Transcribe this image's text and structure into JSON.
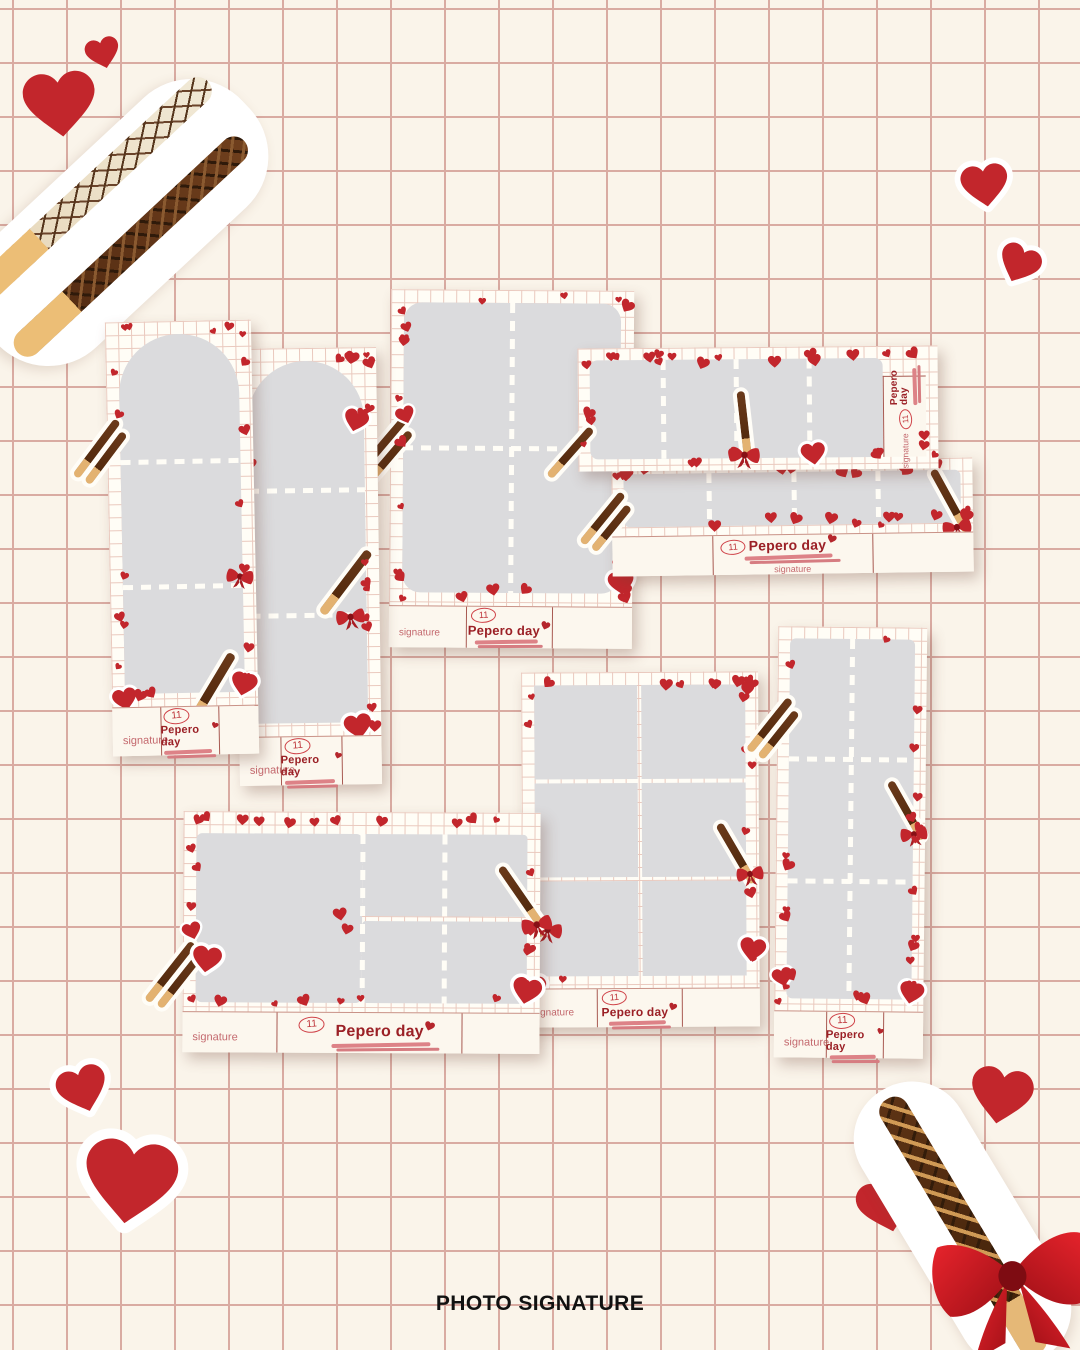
{
  "page": {
    "caption": "PHOTO SIGNATURE",
    "theme": "Pepero Day photo frame templates"
  },
  "labels": {
    "signature": "signature",
    "day_number": "11",
    "title": "Pepero day"
  },
  "colors": {
    "background": "#faf4ea",
    "grid_line": "#d9aba2",
    "card_background": "#fffdf6",
    "card_grid_line": "#eac9be",
    "photo_placeholder": "#dbdbdd",
    "heart_red": "#c2262c",
    "title_red": "#9b2026",
    "underline_pink": "#dd8287",
    "signature_rose": "#c4696e",
    "caption_color": "#111111"
  },
  "cards": [
    {
      "id": "vertical-strip-arch-left",
      "layout": "3 arched cuts, vertical strip",
      "slots": 3
    },
    {
      "id": "vertical-strip-arch-right",
      "layout": "3 arched cuts, vertical strip",
      "slots": 3
    },
    {
      "id": "grid-2x2-portrait",
      "layout": "4 cuts, 2x2 grid",
      "slots": 4
    },
    {
      "id": "horizontal-strip-top",
      "layout": "4 cuts, horizontal strip with side label",
      "slots": 4
    },
    {
      "id": "horizontal-strip-bottom",
      "layout": "4 cuts, horizontal strip",
      "slots": 4
    },
    {
      "id": "landscape-1-plus-4",
      "layout": "1 large cut + 2x2 grid",
      "slots": 5
    },
    {
      "id": "grid-2x3-portrait",
      "layout": "6 cuts, 2x3 grid",
      "slots": 6
    },
    {
      "id": "vertical-strip-2x3",
      "layout": "6 cuts, 2x3 strip",
      "slots": 6
    }
  ],
  "decorations": [
    "pepero-sticks-photo",
    "red-heart-sticker",
    "red-bow",
    "chocolate-almond-pepero"
  ]
}
